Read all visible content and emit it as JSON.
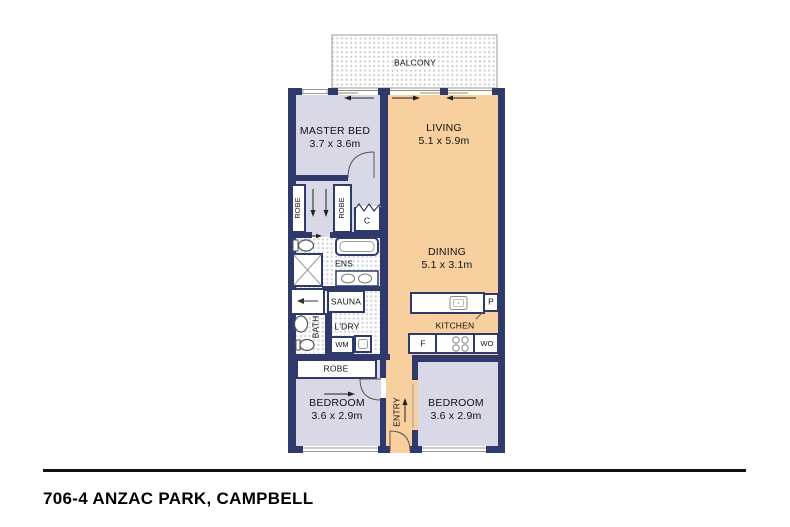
{
  "title": "706-4 ANZAC PARK, CAMPBELL",
  "colors": {
    "wall": "#2f3a6b",
    "floor_light": "#d8d8e6",
    "floor_warm": "#f8cf9e",
    "balcony_dot": "#c6c6c6",
    "tile_dot": "#d2d2de"
  },
  "rooms": {
    "balcony": {
      "name": "BALCONY"
    },
    "master_bed": {
      "name": "MASTER BED",
      "dims": "3.7 x 3.6m"
    },
    "living": {
      "name": "LIVING",
      "dims": "5.1 x 5.9m"
    },
    "dining": {
      "name": "DINING",
      "dims": "5.1 x 3.1m"
    },
    "kitchen": {
      "name": "KITCHEN"
    },
    "bedroom_left": {
      "name": "BEDROOM",
      "dims": "3.6 x 2.9m"
    },
    "bedroom_right": {
      "name": "BEDROOM",
      "dims": "3.6 x 2.9m"
    },
    "entry": {
      "name": "ENTRY"
    },
    "ensuite": {
      "name": "ENS"
    },
    "bath": {
      "name": "BATH"
    },
    "sauna": {
      "name": "SAUNA"
    },
    "laundry": {
      "name": "L'DRY"
    }
  },
  "fixtures": {
    "robe_master_left": "ROBE",
    "robe_master_right": "ROBE",
    "robe_bedroom": "ROBE",
    "closet": "C",
    "washing_machine": "WM",
    "fridge": "F",
    "pantry": "P",
    "wall_oven": "WO"
  }
}
